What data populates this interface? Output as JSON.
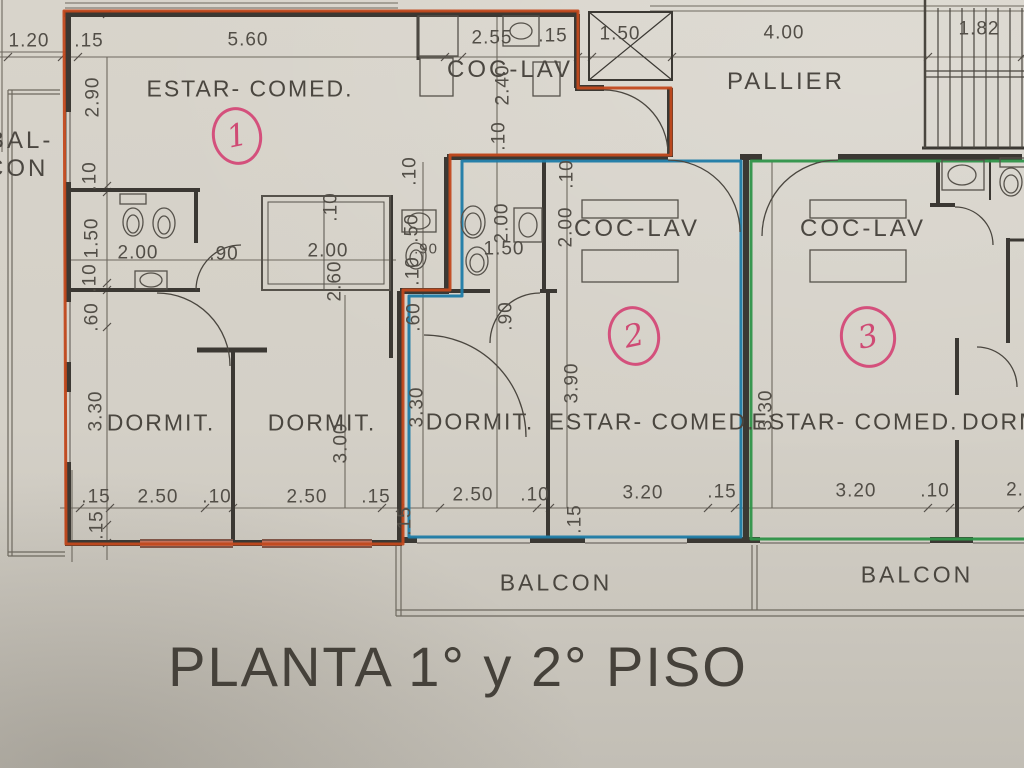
{
  "title": "PLANTA 1° y 2° PISO",
  "colors": {
    "apt1_outline": "#c2491d",
    "apt2_outline": "#1e7ba6",
    "apt3_outline": "#2f9349",
    "annotation_pink": "#d4507c",
    "wall": "#3b3833",
    "paper": "#d6d2c9"
  },
  "units": {
    "apt1": {
      "number": "1",
      "living": "ESTAR- COMED.",
      "kitchen": "COC-LAV",
      "bedroom_a": "DORMIT.",
      "bedroom_b": "DORMIT."
    },
    "apt2": {
      "number": "2",
      "living": "ESTAR- COMED.",
      "kitchen": "COC-LAV",
      "bedroom": "DORMIT."
    },
    "apt3": {
      "number": "3",
      "living": "ESTAR- COMED.",
      "kitchen": "COC-LAV",
      "bedroom": "DORMIT."
    }
  },
  "common_areas": {
    "hall": "PALLIER",
    "balcony_left_line1": "BAL-",
    "balcony_left_line2": "CON",
    "balcony_mid": "BALCON",
    "balcony_right": "BALCON"
  },
  "dims_top": [
    "1.20",
    ".15",
    "5.60",
    "2.55",
    ".15",
    "1.50",
    "4.00",
    "1.82"
  ],
  "dims_left": [
    "2.90",
    ".10",
    "1.50",
    ".10",
    ".60",
    "3.30",
    ".15"
  ],
  "dims_bottom": [
    ".15",
    "2.50",
    ".10",
    "2.50",
    ".15",
    "2.50",
    ".10",
    "3.20",
    ".15",
    "3.20",
    ".10",
    "2."
  ],
  "dims_inner": {
    "apt1_bath_width": "2.00",
    "apt1_bath_door": ".90",
    "apt1_ward_depth": ".10",
    "apt1_ward_width": "2.00",
    "apt1_ward_height": "2.60",
    "apt1_kitchen_depth": "2.40",
    "apt1_kitchen_wall": ".10",
    "apt1_bed2_width": "3.00",
    "apt2_wall_top": ".10",
    "apt2_bath_left": ".50",
    "apt2_bath_small": ".90",
    "apt2_wall_mid": ".10",
    "apt2_hall": ".60",
    "apt2_bath_depth": "2.00",
    "apt2_bath_width": "1.50",
    "apt2_door": ".90",
    "apt2_kitchen_wall": ".10",
    "apt2_kitchen_depth": "2.00",
    "apt2_living_depth": "3.90",
    "apt2_bed_depth": "3.30",
    "apt2_corner": ".15",
    "apt2_corner2": ".15",
    "apt3_bed_depth": "3.30"
  }
}
